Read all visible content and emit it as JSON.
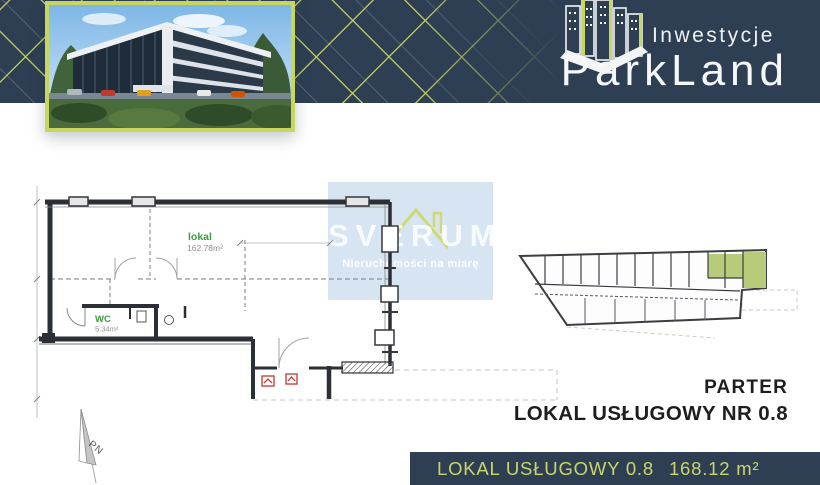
{
  "colors": {
    "navy": "#2e3f54",
    "lime": "#c9d75f",
    "highlight_green": "#b7cb7a",
    "watermark_bg": "#d4e2f0",
    "plan_label_green": "#3f9b40",
    "heading_dark": "#1d1e20"
  },
  "header": {
    "brand_top": "Inwestycje",
    "brand_name": "ParkLand"
  },
  "plan": {
    "room_label": "lokal",
    "room_area": "162.78m²",
    "wc_label": "WC",
    "wc_area": "5.34m²"
  },
  "watermark": {
    "brand": "SVERUM",
    "tagline": "Nieruchomości na miarę"
  },
  "section": {
    "floor_label": "PARTER",
    "unit_label": "LOKAL USŁUGOWY NR 0.8"
  },
  "footer": {
    "unit": "LOKAL USŁUGOWY 0.8",
    "area": "168.12 m²"
  },
  "compass": {
    "label": "PN"
  }
}
